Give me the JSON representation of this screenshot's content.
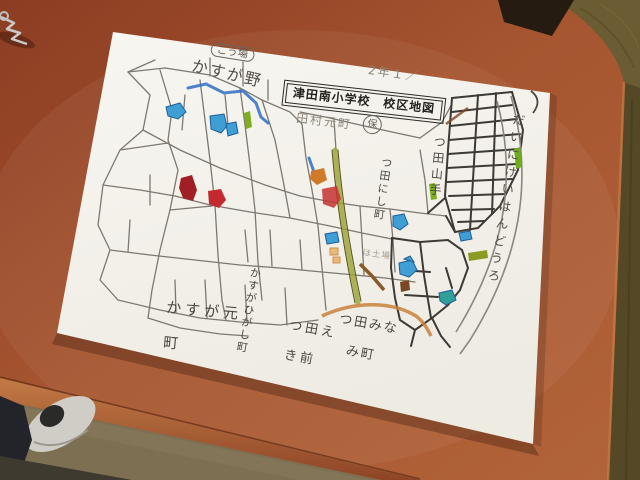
{
  "map": {
    "title": "津田南小学校　校区地図",
    "grade_note": "2年１／",
    "legend_factory": "こう場",
    "school_note": "田村元町",
    "hoiku_mark": "保",
    "areas": {
      "kasugano": "かすが野",
      "tsuda_nishi_cho": "つ田にし町",
      "tsuda_yamate": "つ田山手",
      "daini_keihan_road": "だいにけいはんどうろ",
      "kasuga_moto_line1": "かすが元",
      "kasuga_moto_line2": "町",
      "kasuga_higashi_cho": "かすがひがし町",
      "tsuda_ekimae_line1": "つ田え",
      "tsuda_ekimae_line2": "き前",
      "tsuda_minami_line1": "つ田みな",
      "tsuda_minami_line2": "み町",
      "factory_note": "ほ土場"
    },
    "feature_colors": {
      "pond_blue": "#3f9fd4",
      "pond_teal": "#2f9f97",
      "marker_red": "#c22a2e",
      "marker_dark_red": "#a01f25",
      "marker_orange": "#d07a28",
      "marker_green": "#7fae1e",
      "road_orange": "#c8813c",
      "railway_olive": "#9aa12f",
      "river_blue": "#2f6fc4"
    }
  },
  "photo": {
    "table_color": "#a5552f",
    "floor_color": "#6b5c33",
    "paper_color": "#f6f4ee"
  }
}
